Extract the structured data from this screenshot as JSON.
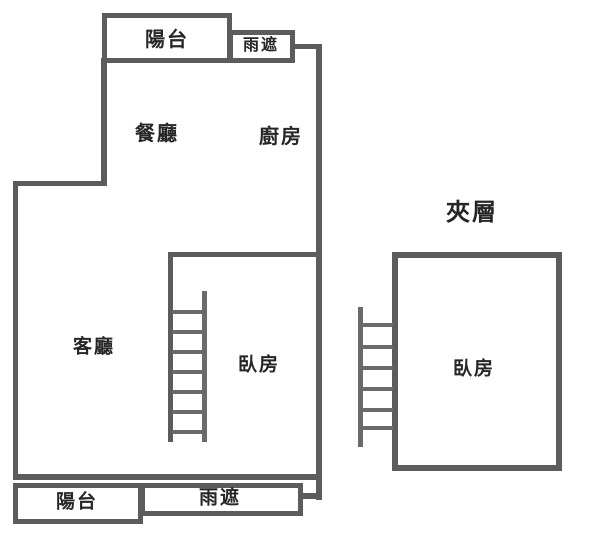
{
  "colors": {
    "wall": "#5c5c5c",
    "ladder": "#6a6a6a",
    "text": "#262626",
    "bg": "#ffffff"
  },
  "plan": {
    "main_unit": {
      "balcony_top_label": "陽台",
      "rain_shield_top_label": "雨遮",
      "dining_label": "餐廳",
      "kitchen_label": "廚房",
      "living_label": "客廳",
      "bedroom_label": "臥房",
      "balcony_bottom_label": "陽台",
      "rain_shield_bottom_label": "雨遮"
    },
    "mezzanine": {
      "title_label": "夾層",
      "bedroom_label": "臥房"
    }
  }
}
